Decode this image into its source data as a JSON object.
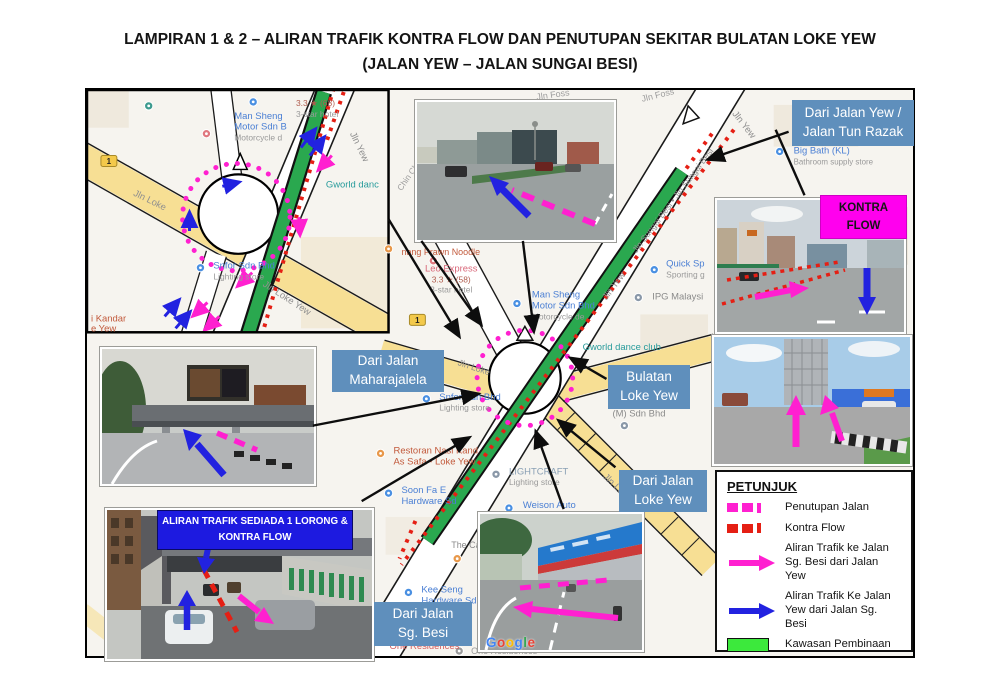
{
  "title": {
    "line1": "LAMPIRAN 1 & 2 – ALIRAN TRAFIK KONTRA FLOW DAN PENUTUPAN SEKITAR BULATAN LOKE YEW",
    "line2": "(JALAN YEW – JALAN SUNGAI BESI)"
  },
  "colors": {
    "callout_blue": "#5f8fbc",
    "banner_blue": "#1d1ae0",
    "magenta": "#ff20d0",
    "kontra_label_magenta": "#ff00ee",
    "red": "#e51f14",
    "arrow_blue": "#2222e0",
    "construction_green": "#2aa84f",
    "legend_green": "#3ce93c",
    "road_yellow": "#f7df94"
  },
  "callouts": {
    "dari_jalan_yew_tun_razak": {
      "line1": "Dari Jalan Yew /",
      "line2": "Jalan Tun Razak"
    },
    "kontra_flow": {
      "line1": "KONTRA",
      "line2": "FLOW"
    },
    "dari_jalan_maharajalela": {
      "line1": "Dari Jalan",
      "line2": "Maharajalela"
    },
    "bulatan_loke_yew": {
      "line1": "Bulatan",
      "line2": "Loke Yew"
    },
    "dari_jalan_loke_yew": {
      "line1": "Dari Jalan",
      "line2": "Loke Yew"
    },
    "dari_jalan_sg_besi": {
      "line1": "Dari Jalan",
      "line2": "Sg. Besi"
    },
    "banner": {
      "line1": "ALIRAN TRAFIK SEDIADA 1 LORONG &",
      "line2": "KONTRA FLOW"
    }
  },
  "legend": {
    "title": "PETUNJUK",
    "penutupan": {
      "label": "Penutupan Jalan"
    },
    "kontra": {
      "label": "Kontra Flow"
    },
    "aliran_magenta": {
      "line1": "Aliran Trafik ke Jalan",
      "line2": "Sg. Besi dari Jalan Yew"
    },
    "aliran_blue": {
      "line1": "Aliran Trafik Ke Jalan",
      "line2": "Yew dari Jalan Sg. Besi"
    },
    "kawasan": {
      "label": "Kawasan Pembinaan"
    }
  },
  "watermark": {
    "letters": [
      [
        "G",
        "#4285F4"
      ],
      [
        "o",
        "#EA4335"
      ],
      [
        "o",
        "#FBBC05"
      ],
      [
        "g",
        "#4285F4"
      ],
      [
        "l",
        "#34A853"
      ],
      [
        "e",
        "#EA4335"
      ]
    ]
  },
  "map": {
    "labels": [
      {
        "t": "Jln Foss",
        "x": 452,
        "y": 10,
        "c": "#9d9d9d",
        "s": 9,
        "r": -8
      },
      {
        "t": "Jln Foss",
        "x": 558,
        "y": 12,
        "c": "#9d9d9d",
        "s": 9,
        "r": -14
      },
      {
        "t": "Jln Yew",
        "x": 648,
        "y": 24,
        "c": "#8f8f8f",
        "s": 9.5,
        "r": 52
      },
      {
        "t": "Jln Sungai Besi • Jln Sungai Besi",
        "x": 591,
        "y": 113,
        "c": "#8f8f8f",
        "s": 8.8,
        "r": -53,
        "a": 1
      },
      {
        "t": "Jln Yew",
        "x": 522,
        "y": 212,
        "c": "#8f8f8f",
        "s": 9.5,
        "r": -53
      },
      {
        "t": "Chin Chin",
        "x": 316,
        "y": 102,
        "c": "#9d9d9d",
        "s": 8.5,
        "r": -55
      },
      {
        "t": "Man Sheng",
        "x": 447,
        "y": 209,
        "c": "#4a7fd4",
        "s": 9.5
      },
      {
        "t": "Motor Sdn Bhd",
        "x": 447,
        "y": 220,
        "c": "#4a7fd4",
        "s": 9.5
      },
      {
        "t": "Motorcycle de",
        "x": 447,
        "y": 231,
        "c": "#9a9a9a",
        "s": 8.5
      },
      {
        "t": "Leo Express",
        "x": 366,
        "y": 183,
        "c": "#d9687a",
        "s": 9.5,
        "a": 1
      },
      {
        "t": "3.3 ★ (58)",
        "x": 366,
        "y": 194,
        "c": "#b05c4e",
        "s": 8.5,
        "a": 1
      },
      {
        "t": "3-star hotel",
        "x": 366,
        "y": 204,
        "c": "#9a9a9a",
        "s": 8.5,
        "a": 1
      },
      {
        "t": "nang Prawn Noodle",
        "x": 316,
        "y": 166,
        "c": "#c25a3c",
        "s": 9
      },
      {
        "t": "Gworld dance club",
        "x": 498,
        "y": 262,
        "c": "#279b9b",
        "s": 9.5
      },
      {
        "t": "Quick Sp",
        "x": 582,
        "y": 178,
        "c": "#4a7fd4",
        "s": 9.5
      },
      {
        "t": "Sporting g",
        "x": 582,
        "y": 189,
        "c": "#9a9a9a",
        "s": 8.5
      },
      {
        "t": "IPG Malaysi",
        "x": 568,
        "y": 211,
        "c": "#8a8a8a",
        "s": 9.5
      },
      {
        "t": "Big Bath (KL)",
        "x": 710,
        "y": 64,
        "c": "#4a7fd4",
        "s": 9.5
      },
      {
        "t": "Bathroom supply store",
        "x": 710,
        "y": 75,
        "c": "#9a9a9a",
        "s": 8
      },
      {
        "t": "HTC Travel Serv",
        "x": 528,
        "y": 318,
        "c": "#8a8a8a",
        "s": 9.5
      },
      {
        "t": "(M) Sdn Bhd",
        "x": 528,
        "y": 329,
        "c": "#8a8a8a",
        "s": 9.5
      },
      {
        "t": "Snfor Sdn Bhd",
        "x": 354,
        "y": 312,
        "c": "#4a7fd4",
        "s": 9.5
      },
      {
        "t": "Lighting store",
        "x": 354,
        "y": 323,
        "c": "#9a9a9a",
        "s": 8.5
      },
      {
        "t": "Restoran Nasi Kand",
        "x": 308,
        "y": 366,
        "c": "#c25a3c",
        "s": 9.5
      },
      {
        "t": "As Safa - Loke Yew",
        "x": 308,
        "y": 377,
        "c": "#c25a3c",
        "s": 9.5
      },
      {
        "t": "LIGHTCRAFT",
        "x": 424,
        "y": 387,
        "c": "#8aa0b5",
        "s": 9.5
      },
      {
        "t": "Lighting store",
        "x": 424,
        "y": 398,
        "c": "#9a9a9a",
        "s": 8.5
      },
      {
        "t": "Soon Fa E",
        "x": 316,
        "y": 406,
        "c": "#4a7fd4",
        "s": 9.5
      },
      {
        "t": "Hardware Sd",
        "x": 316,
        "y": 417,
        "c": "#4a7fd4",
        "s": 9.5
      },
      {
        "t": "Weison Auto",
        "x": 438,
        "y": 421,
        "c": "#4a7fd4",
        "s": 9.5
      },
      {
        "t": "The Ca",
        "x": 366,
        "y": 461,
        "c": "#8a8a8a",
        "s": 9
      },
      {
        "t": "Kee Seng",
        "x": 336,
        "y": 506,
        "c": "#4a7fd4",
        "s": 9.5
      },
      {
        "t": "Hardware Sdn Bhd",
        "x": 336,
        "y": 517,
        "c": "#4a7fd4",
        "s": 9.5
      },
      {
        "t": "Jln Loke",
        "x": 372,
        "y": 277,
        "c": "#8f8f8f",
        "s": 9,
        "r": 18
      },
      {
        "t": "Jln Loke Yew",
        "x": 518,
        "y": 390,
        "c": "#8f8f8f",
        "s": 9.5,
        "r": 44
      },
      {
        "t": "Sungai",
        "x": 246,
        "y": 554,
        "c": "#8f8f8f",
        "s": 9,
        "r": -72
      },
      {
        "t": "One Residences",
        "x": 304,
        "y": 563,
        "c": "#d75f5f",
        "s": 9.5
      },
      {
        "t": "One Residences",
        "x": 386,
        "y": 568,
        "c": "#9a9a9a",
        "s": 9
      },
      {
        "t": "Man Sheng",
        "x": 148,
        "y": 29,
        "c": "#4a7fd4",
        "s": 9.5
      },
      {
        "t": "Motor Sdn B",
        "x": 148,
        "y": 40,
        "c": "#4a7fd4",
        "s": 9.5
      },
      {
        "t": "Motorcycle d",
        "x": 148,
        "y": 51,
        "c": "#9a9a9a",
        "s": 8.5
      },
      {
        "t": "3.3 ★ (68)",
        "x": 210,
        "y": 16,
        "c": "#b05c4e",
        "s": 8.5
      },
      {
        "t": "3-star hotel",
        "x": 210,
        "y": 27,
        "c": "#9a9a9a",
        "s": 8.5
      },
      {
        "t": "Gworld danc",
        "x": 240,
        "y": 98,
        "c": "#279b9b",
        "s": 9.5
      },
      {
        "t": "Snfor Sdn Bhd",
        "x": 127,
        "y": 180,
        "c": "#4a7fd4",
        "s": 9.5
      },
      {
        "t": "Lighting store",
        "x": 127,
        "y": 191,
        "c": "#9a9a9a",
        "s": 8.5
      },
      {
        "t": "i Kandar",
        "x": 4,
        "y": 233,
        "c": "#c25a3c",
        "s": 9.5
      },
      {
        "t": "e Yew",
        "x": 4,
        "y": 243,
        "c": "#c25a3c",
        "s": 9.5
      },
      {
        "t": "Jln Loke",
        "x": 46,
        "y": 106,
        "c": "#8f8f8f",
        "s": 9.5,
        "r": 26
      },
      {
        "t": "Jln Yew",
        "x": 264,
        "y": 44,
        "c": "#8f8f8f",
        "s": 9.5,
        "r": 64
      },
      {
        "t": "Jln Loke Yew",
        "x": 176,
        "y": 197,
        "c": "#8f8f8f",
        "s": 9.5,
        "r": 33
      }
    ],
    "pins": [
      [
        432,
        215,
        "#4a90e2"
      ],
      [
        348,
        172,
        "#e0787f"
      ],
      [
        303,
        160,
        "#e8984a"
      ],
      [
        570,
        181,
        "#4a90e2"
      ],
      [
        554,
        209,
        "#8a98a8"
      ],
      [
        696,
        62,
        "#4a90e2"
      ],
      [
        540,
        338,
        "#8a98a8"
      ],
      [
        341,
        311,
        "#4a90e2"
      ],
      [
        295,
        366,
        "#e8984a"
      ],
      [
        411,
        387,
        "#8a98a8"
      ],
      [
        303,
        406,
        "#4a90e2"
      ],
      [
        424,
        421,
        "#4a90e2"
      ],
      [
        372,
        472,
        "#e8984a"
      ],
      [
        323,
        506,
        "#4a90e2"
      ],
      [
        374,
        565,
        "#9a9a9a"
      ],
      [
        167,
        12,
        "#4a90e2"
      ],
      [
        120,
        44,
        "#e0787f"
      ],
      [
        62,
        16,
        "#3d9b8f"
      ],
      [
        114,
        179,
        "#4a90e2"
      ]
    ],
    "shields": [
      {
        "t": "1",
        "x": 324,
        "y": 226
      },
      {
        "t": "1",
        "x": 14,
        "y": 66
      }
    ]
  }
}
